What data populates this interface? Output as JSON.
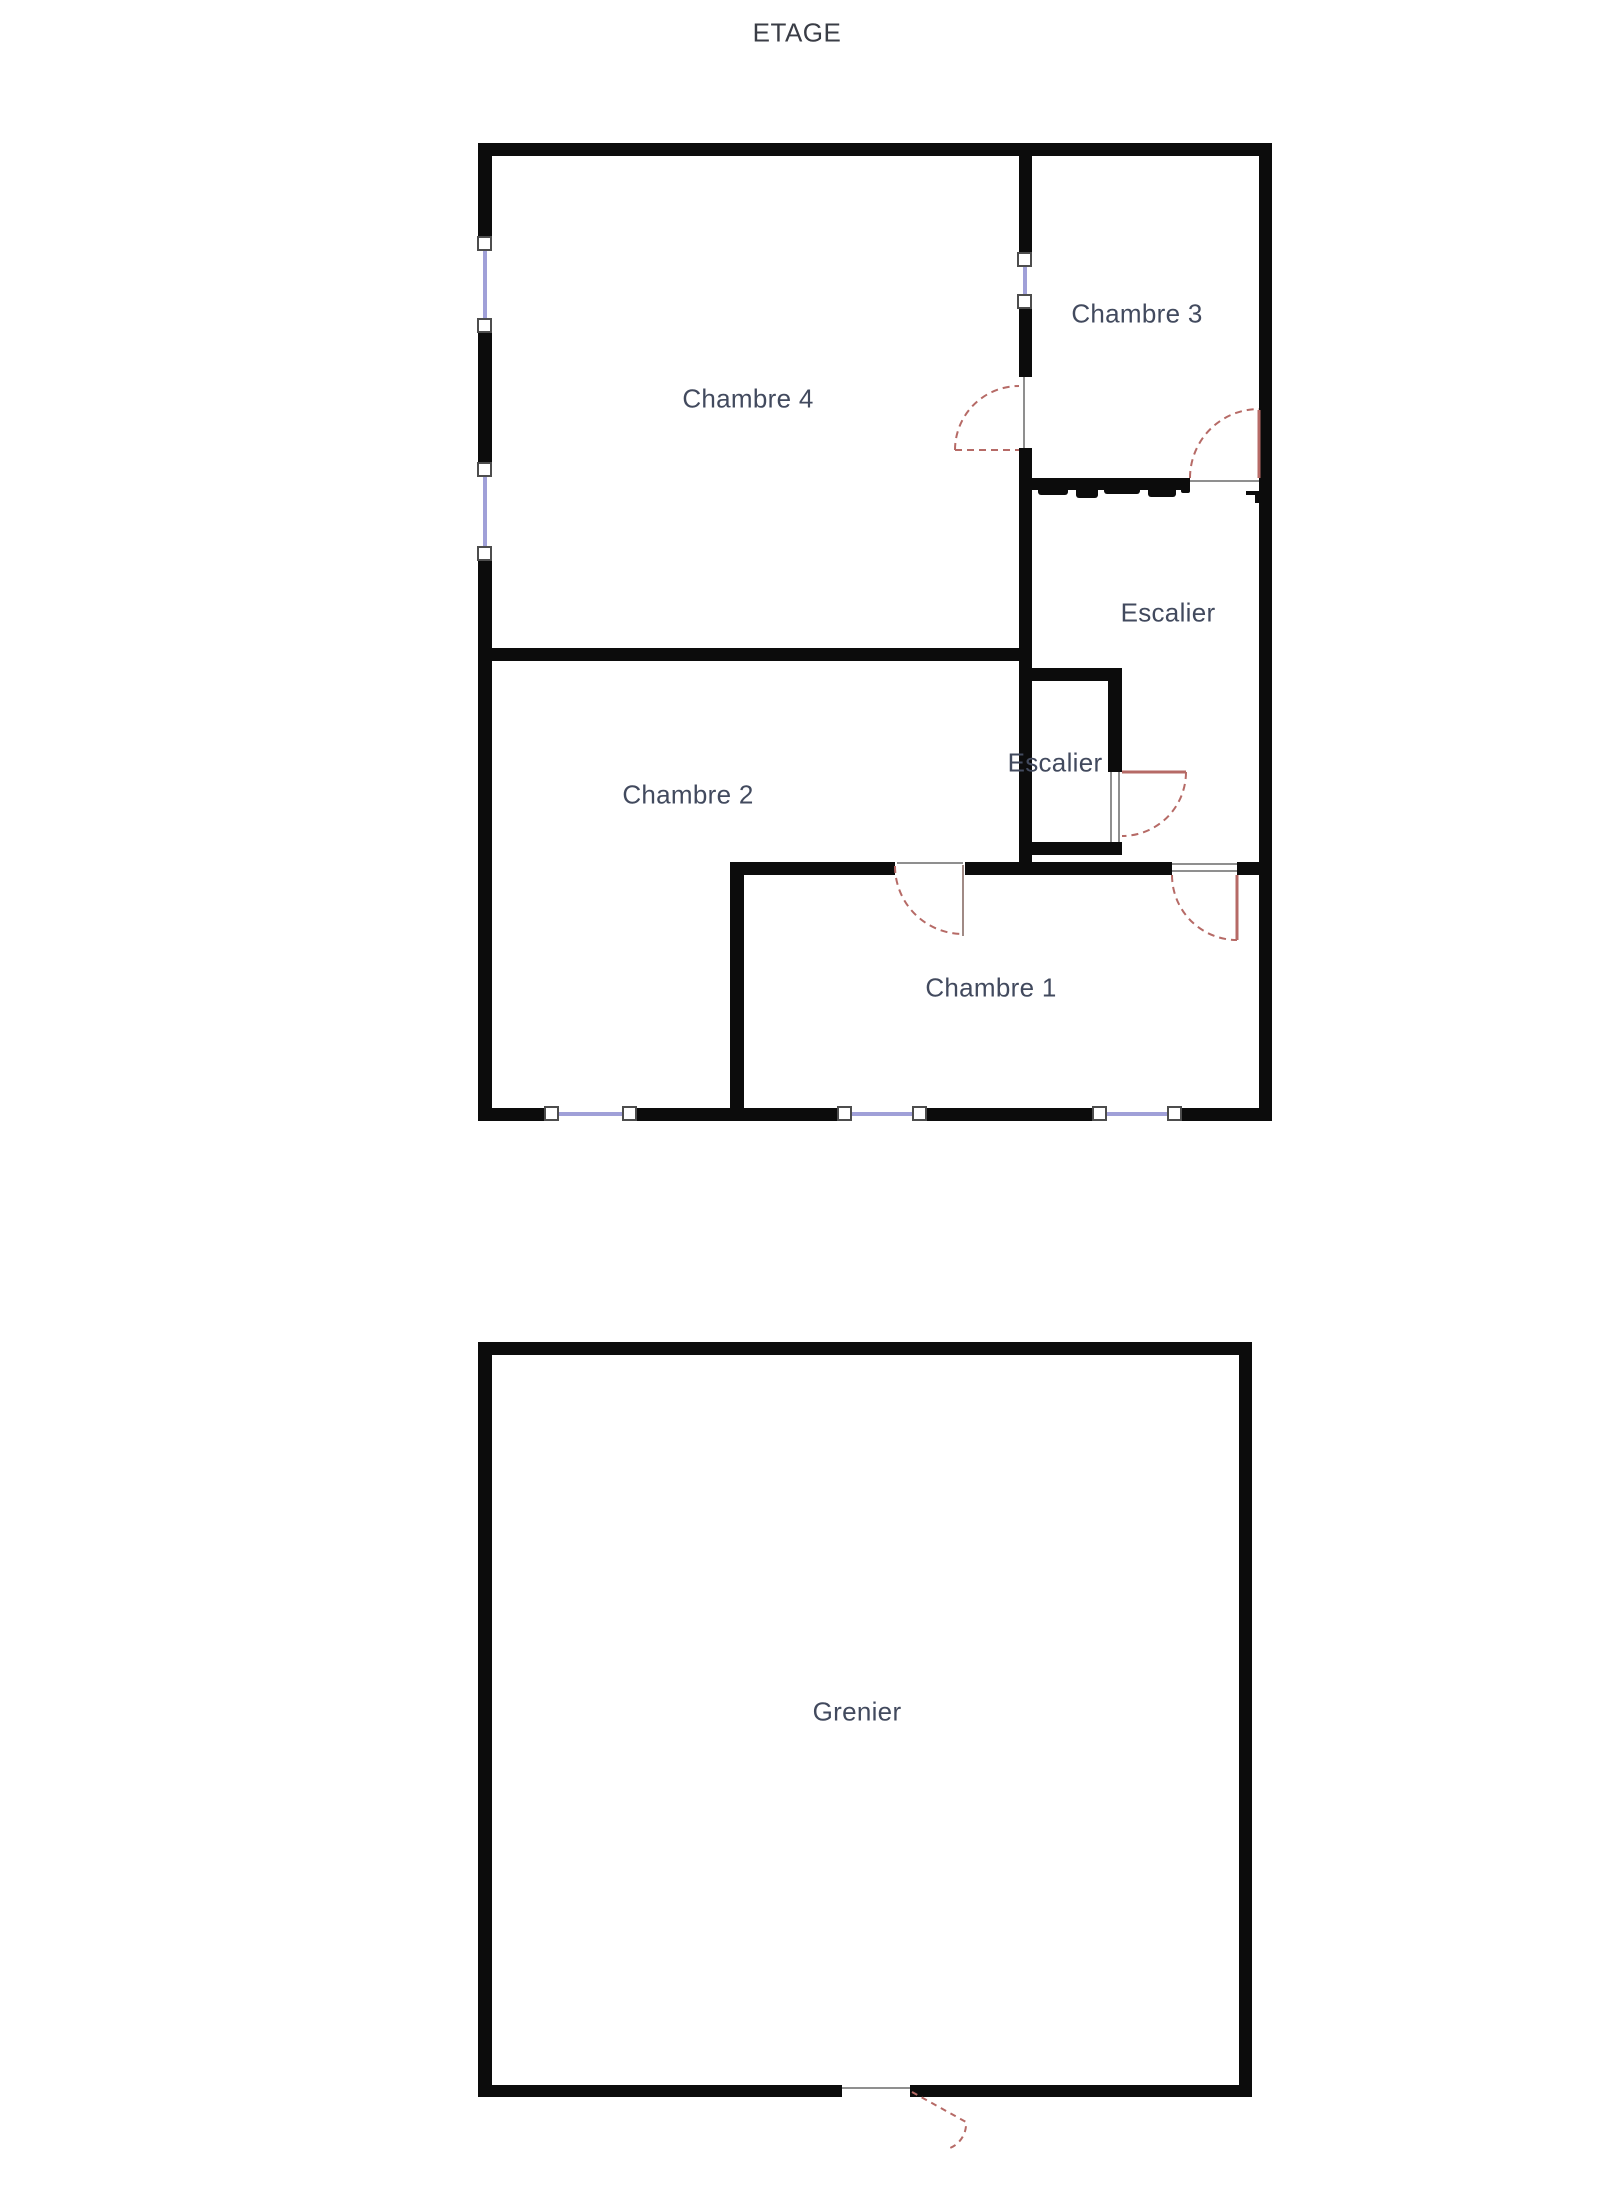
{
  "title": {
    "text": "ETAGE"
  },
  "floors": {
    "upper": {
      "rooms": [
        {
          "id": "chambre4",
          "label": "Chambre 4"
        },
        {
          "id": "chambre3",
          "label": "Chambre 3"
        },
        {
          "id": "escalier_hall",
          "label": "Escalier"
        },
        {
          "id": "escalier_box",
          "label": "Escalier"
        },
        {
          "id": "chambre2",
          "label": "Chambre 2"
        },
        {
          "id": "chambre1",
          "label": "Chambre 1"
        }
      ]
    },
    "attic": {
      "rooms": [
        {
          "id": "grenier",
          "label": "Grenier"
        }
      ]
    }
  },
  "colors": {
    "background": "#ffffff",
    "wall": "#0c0c0c",
    "door_swing": "#b66a66",
    "door_leaf_alt": "#a08a85",
    "window_line": "#a0a0d8",
    "window_handle_fill": "#ffffff",
    "window_handle_border": "#4d4d4d",
    "frame_line": "#8f8f8f",
    "label_text": "#424a5e"
  }
}
